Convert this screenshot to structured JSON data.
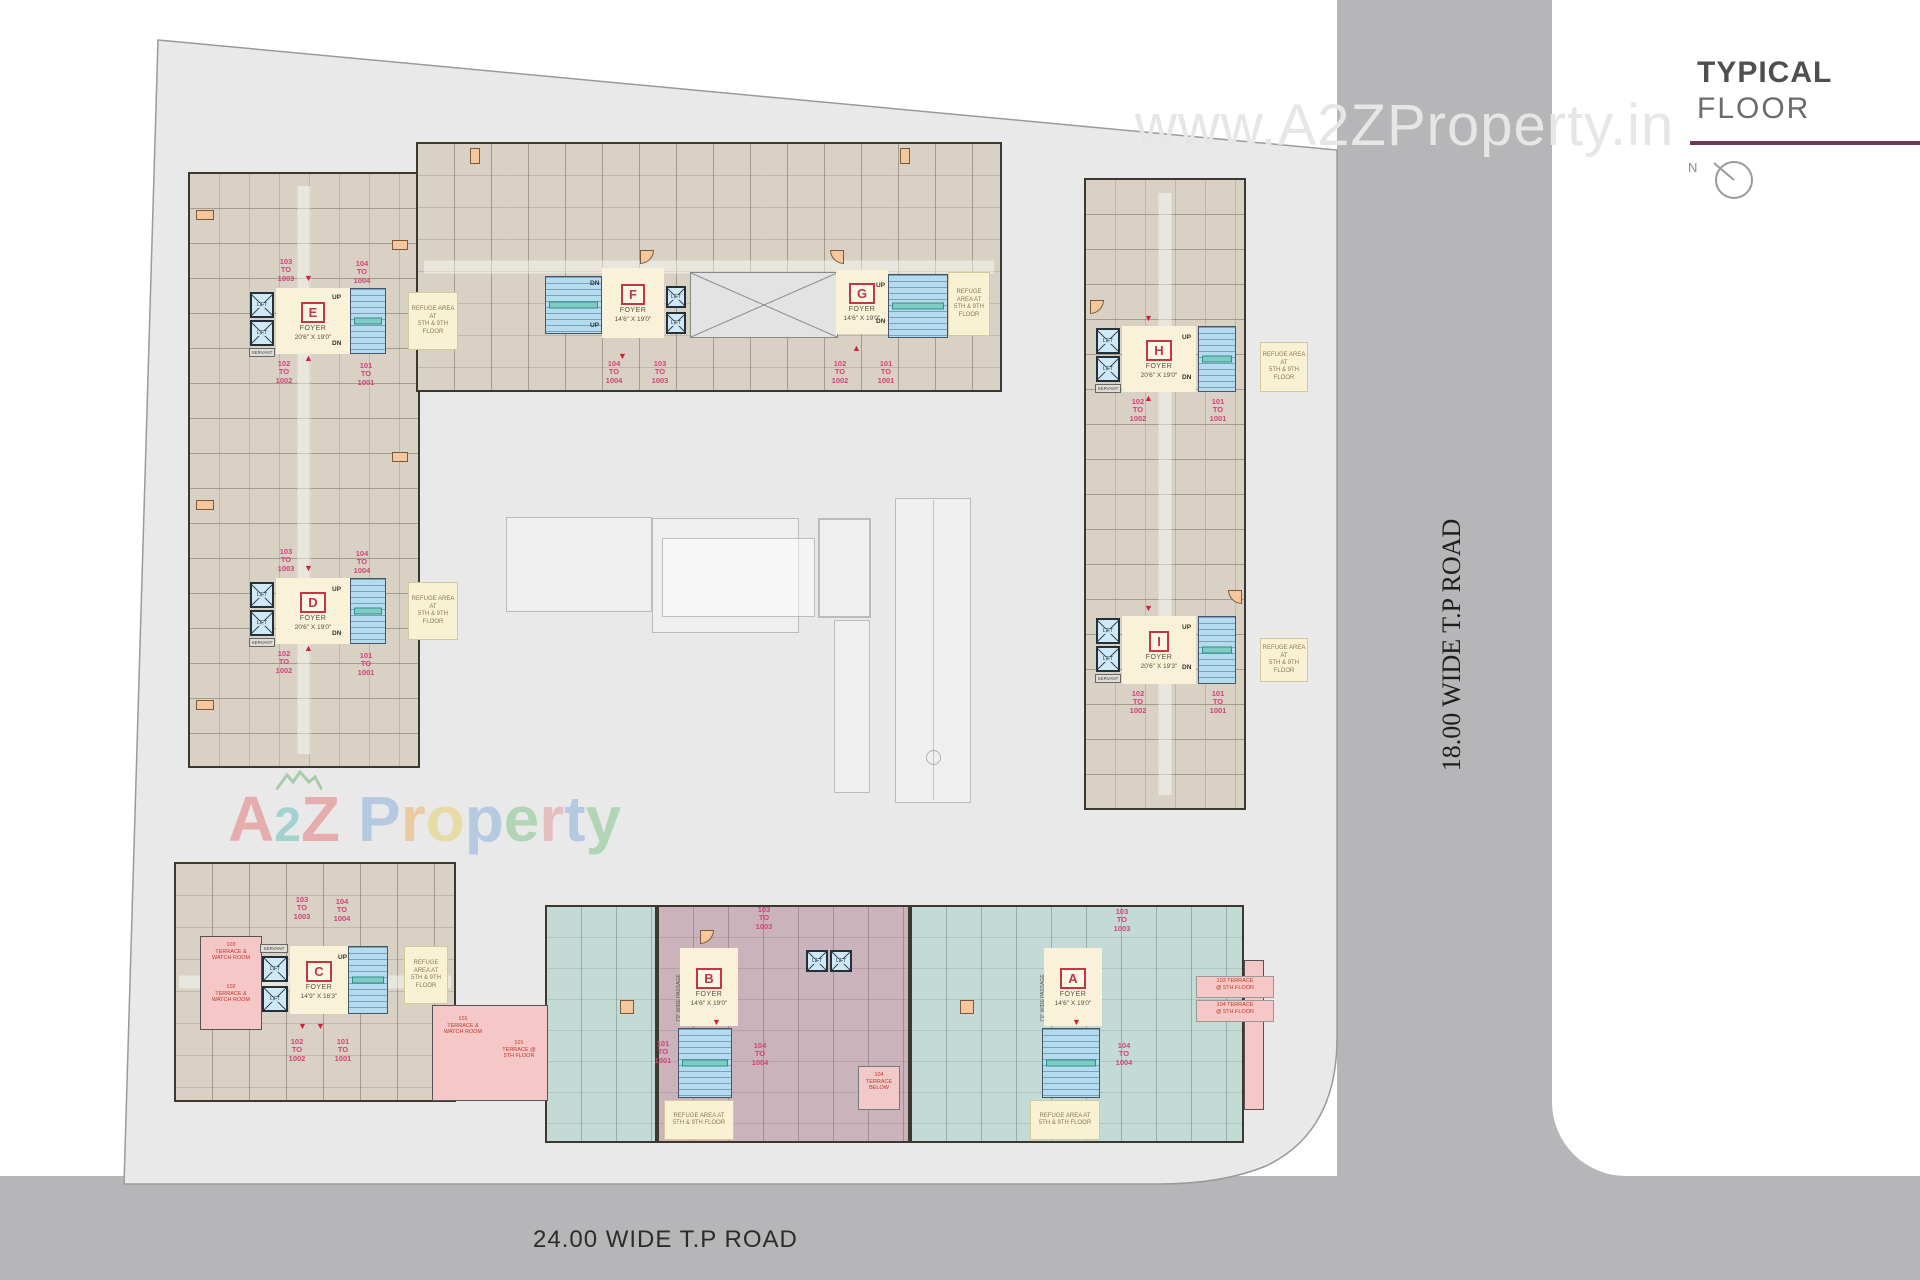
{
  "title": {
    "line1": "TYPICAL",
    "line2": "FLOOR"
  },
  "compass": {
    "north_label": "N"
  },
  "watermarks": {
    "top": "www.A2ZProperty.in",
    "center_text": "A2Z Property",
    "center_letters": [
      "A",
      "2",
      "Z",
      "P",
      "r",
      "o",
      "p",
      "e",
      "r",
      "t",
      "y"
    ],
    "center_letter_colors": [
      "#e05c5c",
      "#3fb3ac",
      "#e05c5c",
      "#6f9fd8",
      "#eda23f",
      "#e8c84a",
      "#6f9fd8",
      "#66bd72",
      "#e08585",
      "#6f9fd8",
      "#66bd72"
    ]
  },
  "roads": {
    "bottom_label": "24.00 WIDE T.P ROAD",
    "right_label": "18.00 WIDE T.P ROAD"
  },
  "common": {
    "foyer": "FOYER",
    "lift": "LIFT",
    "up": "UP",
    "dn": "DN",
    "servant": "SERVANT",
    "refuge": "REFUGE AREA AT\n5TH & 9TH FLOOR",
    "passage": "7'0\" WIDE PASSAGE"
  },
  "blocks": [
    {
      "letter": "E",
      "foyer_dims": "20'6\" X 19'0\"",
      "u1": "101\nTO\n1001",
      "u2": "102\nTO\n1002",
      "u3": "103\nTO\n1003",
      "u4": "104\nTO\n1004"
    },
    {
      "letter": "F",
      "foyer_dims": "14'6\" X 19'0\"",
      "u1": "101\nTO\n1001",
      "u2": "102\nTO\n1002",
      "u3": "103\nTO\n1003",
      "u4": "104\nTO\n1004"
    },
    {
      "letter": "G",
      "foyer_dims": "14'6\" X 19'0\"",
      "u1": "101\nTO\n1001",
      "u2": "102\nTO\n1002",
      "u3": "103\nTO\n1003",
      "u4": "104\nTO\n1004"
    },
    {
      "letter": "D",
      "foyer_dims": "20'6\" X 19'0\"",
      "u1": "101\nTO\n1001",
      "u2": "102\nTO\n1002",
      "u3": "103\nTO\n1003",
      "u4": "104\nTO\n1004"
    },
    {
      "letter": "H",
      "foyer_dims": "20'6\" X 19'0\"",
      "u1": "101\nTO\n1001",
      "u2": "102\nTO\n1002",
      "u3": "103\nTO\n1003",
      "u4": "104\nTO\n1004"
    },
    {
      "letter": "I",
      "foyer_dims": "20'6\" X 19'3\"",
      "u1": "101\nTO\n1001",
      "u2": "102\nTO\n1002",
      "u3": "103\nTO\n1003",
      "u4": "104\nTO\n1004"
    },
    {
      "letter": "C",
      "foyer_dims": "14'9\" X 16'3\"",
      "u1": "101\nTO\n1001",
      "u2": "102\nTO\n1002",
      "u3": "103\nTO\n1003",
      "u4": "104\nTO\n1004"
    },
    {
      "letter": "B",
      "foyer_dims": "14'6\" X 19'0\"",
      "u1": "101\nTO\n1001",
      "u2": "102\nTO\n1002",
      "u3": "103\nTO\n1003",
      "u4": "104\nTO\n1004"
    },
    {
      "letter": "A",
      "foyer_dims": "14'6\" X 19'0\"",
      "u1": "101\nTO\n1001",
      "u2": "102\nTO\n1002",
      "u3": "103\nTO\n1003",
      "u4": "104\nTO\n1004"
    }
  ],
  "terraces": {
    "c_103": "103\nTERRACE &\nWATCH ROOM",
    "c_102": "102\nTERRACE &\nWATCH ROOM",
    "c_101": "101\nTERRACE &\nWATCH ROOM",
    "c_101b": "101\nTERRACE @\n5TH FLOOR",
    "b_104": "104\nTERRACE\nBELOW",
    "a_103": "103 TERRACE\n@ 5TH FLOOR",
    "a_104": "104 TERRACE\n@ 5TH FLOOR"
  },
  "colors": {
    "site": "#e9e9e9",
    "road": "#b6b6b8",
    "unit_beige": "#d8d1c4",
    "unit_teal": "#c4dbd5",
    "unit_mauve": "#cab3bb",
    "stair_blue": "#b4dbee",
    "foyer_cream": "#faf2d8",
    "terrace_pink": "#f5c7c7",
    "block_letter_red": "#c23645",
    "unit_label_magenta": "#d1457b",
    "title_rule_maroon": "#6e3a57",
    "balcony_orange": "#f6c79d"
  }
}
